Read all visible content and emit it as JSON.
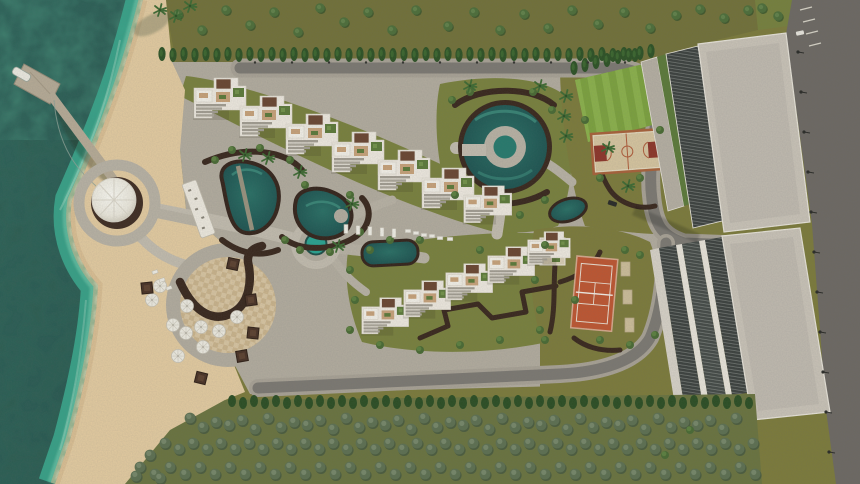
{
  "meta": {
    "title": "Beachfront resort masterplan — aerial 3D render",
    "type": "architectural-visualization",
    "view": "top-down aerial",
    "no_text_visible": true
  },
  "scene": {
    "sea": {
      "label": "sea with surf and seaweed",
      "deep": "#2b5a52",
      "mid": "#2e6e62",
      "surf": "#3aa98e",
      "foam": "#c9edda"
    },
    "beach": {
      "label": "sand beach",
      "sand": "#e4cba1",
      "shade": "#d3b68a"
    },
    "pier": {
      "label": "pier with boat dock and round lookout",
      "deck": "#b7ab97",
      "boat": "#ece9e1",
      "canopy": "#f3f0e8",
      "base": "#402d23"
    },
    "pools": {
      "label": "lagoon pools, ring pool, plaza pool",
      "water": "#1f5a58",
      "glint": "#3e8d7d",
      "bright": "#2aa391"
    },
    "courts": {
      "tennis": {
        "surface": "#bf5632",
        "lines": "#ecdfd2"
      },
      "basketball": {
        "surface": "#d7c5a0",
        "key": "#8e352a",
        "border": "#a9613a"
      },
      "lawn": {
        "base": "#7da23f",
        "stripe": "#8cb14c"
      }
    },
    "buildings": {
      "villas": {
        "wall": "#efe9e0",
        "roof_brown": "#6b4632",
        "roof_tan": "#c8a27a",
        "roof_garden": "#5d7a3a",
        "terrace": "#a39d92"
      },
      "towers": {
        "roof": "#cac3b8",
        "glazing": "#3d413f",
        "trim": "#e9e4da"
      }
    },
    "ground": {
      "pavement": "#b3ac9f",
      "pavement_light": "#c3bcaf",
      "plaza_tile": "#d9c5a2",
      "path_brown": "#3a281e",
      "road": "#7d7973",
      "coastal_road": "#6e6964",
      "grass": "#7d7b3c",
      "garden": "#7a813e"
    },
    "vegetation": {
      "pine": "#4e6e3a",
      "cypress": "#2e5226",
      "forest": "#5e7052",
      "bush": "#4a6a34",
      "palm": "#3f6a33"
    }
  }
}
